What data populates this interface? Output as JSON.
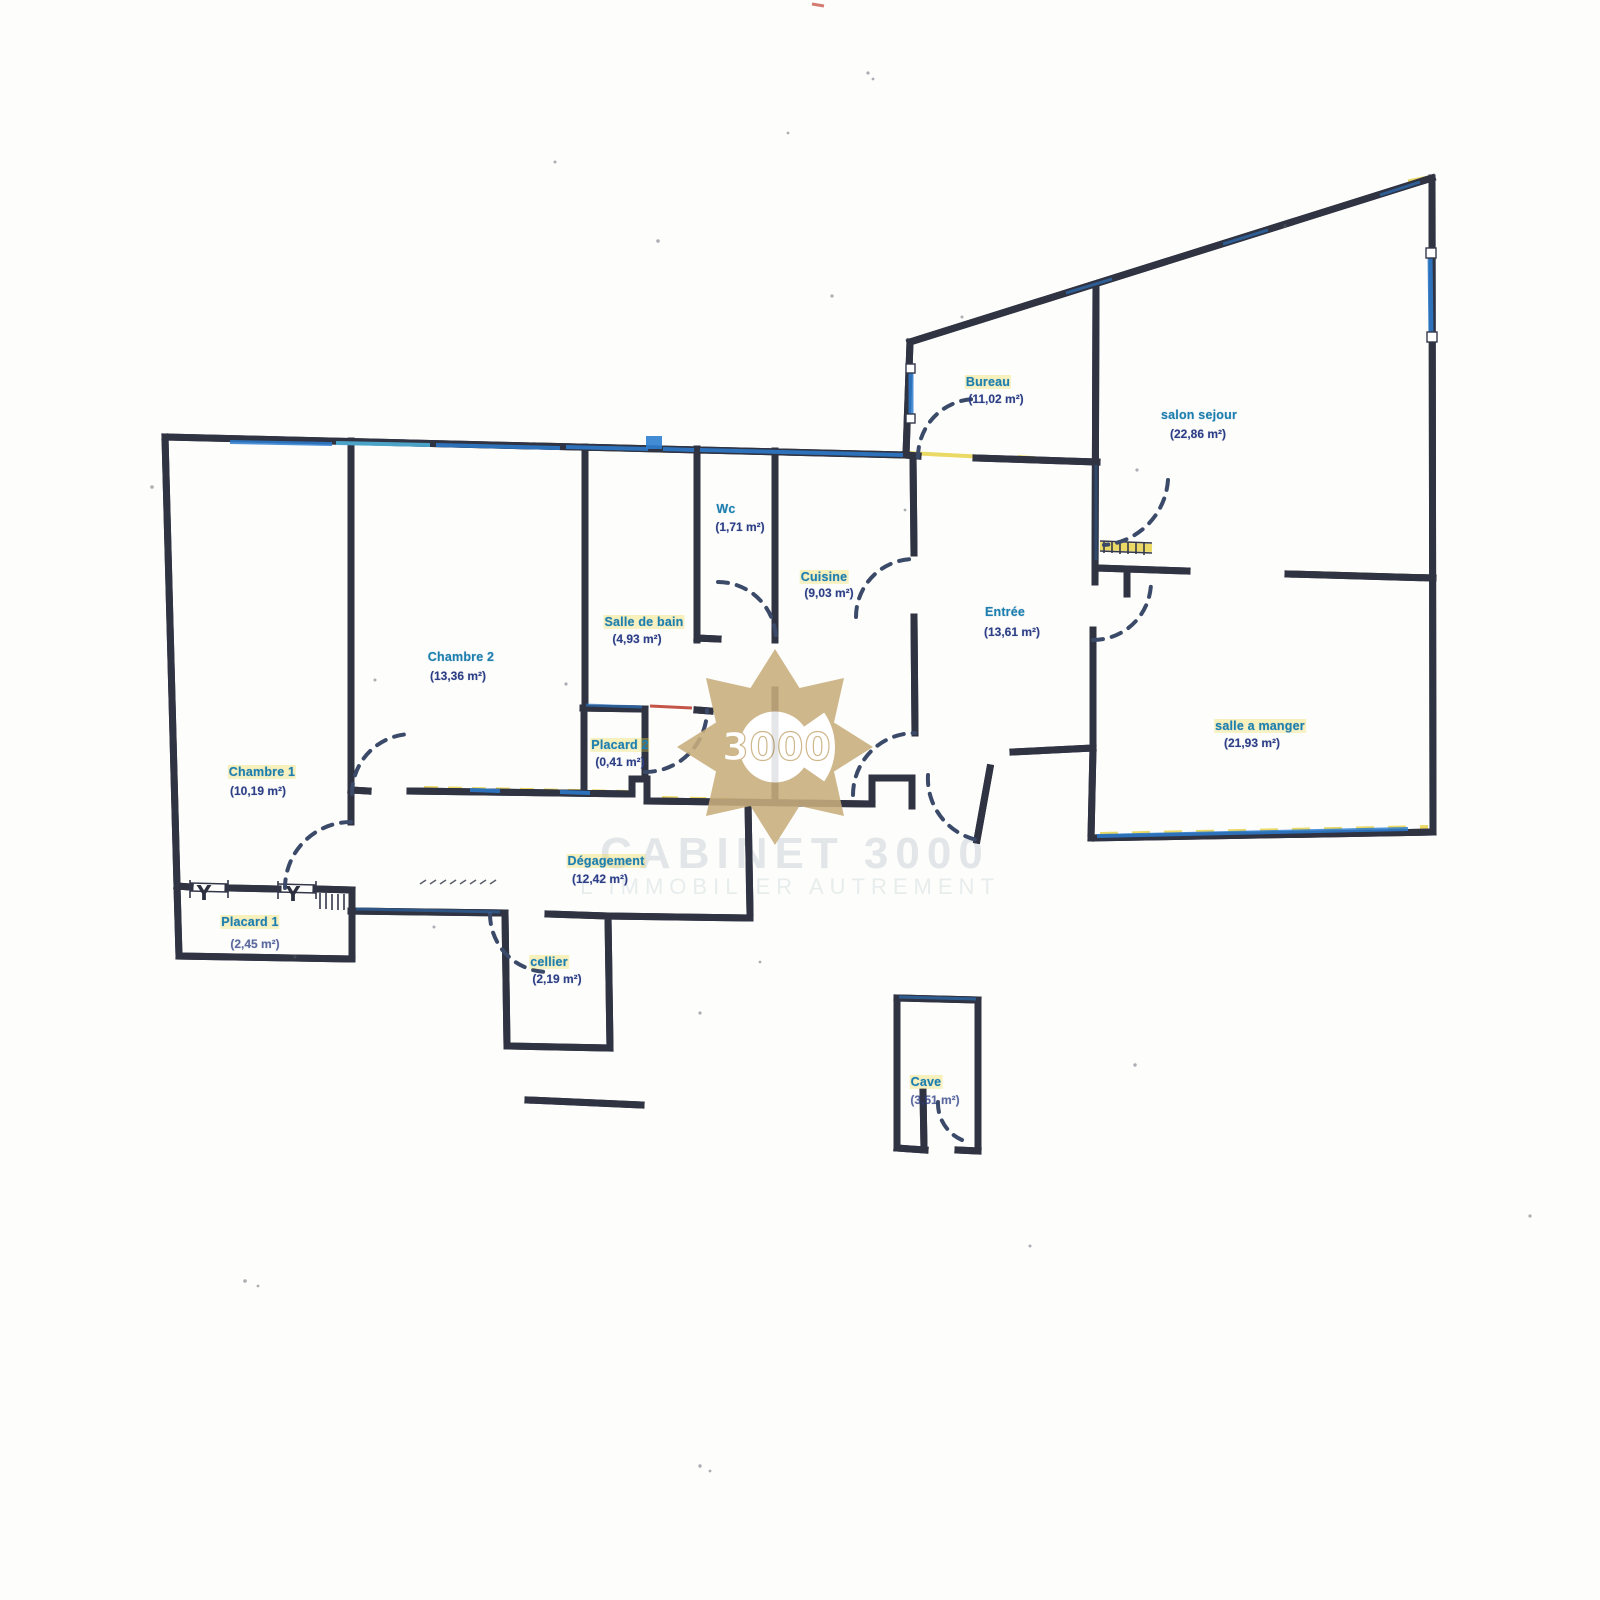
{
  "document": {
    "type": "floor-plan-scan",
    "language": "fr"
  },
  "rooms": {
    "chambre1": {
      "name": "Chambre 1",
      "area": "(10,19 m²)"
    },
    "chambre2": {
      "name": "Chambre 2",
      "area": "(13,36 m²)"
    },
    "salle_de_bain": {
      "name": "Salle de bain",
      "area": "(4,93 m²)"
    },
    "wc": {
      "name": "Wc",
      "area": "(1,71 m²)"
    },
    "placard2": {
      "name": "Placard 2",
      "area": "(0,41 m²)"
    },
    "cuisine": {
      "name": "Cuisine",
      "area": "(9,03 m²)"
    },
    "bureau": {
      "name": "Bureau",
      "area": "(11,02 m²)"
    },
    "salon_sejour": {
      "name": "salon sejour",
      "area": "(22,86 m²)"
    },
    "entree": {
      "name": "Entrée",
      "area": "(13,61 m²)"
    },
    "salle_a_manger": {
      "name": "salle a manger",
      "area": "(21,93 m²)"
    },
    "degagement": {
      "name": "Dégagement",
      "area": "(12,42 m²)"
    },
    "placard1": {
      "name": "Placard 1",
      "area": "(2,45 m²)"
    },
    "cellier": {
      "name": "cellier",
      "area": "(2,19 m²)"
    },
    "cave": {
      "name": "Cave",
      "area": "(3,51 m²)"
    }
  },
  "watermark": {
    "letter": "C",
    "number": "3000",
    "line1": "CABINET 3000",
    "line2": "L'IMMOBILIER AUTREMENT",
    "gold": "#c9ae7d"
  },
  "windows": {
    "symbol": "Y"
  },
  "colors": {
    "wall": "#2f3342",
    "door_arc": "#3a4a68",
    "highlight_blue": "#2e7ed0",
    "highlight_cyan": "#53c0ea",
    "highlight_yellow": "#e8d34a",
    "artifact_red": "#c04335",
    "label_name": "#1d7fae",
    "label_area": "#2c3e85"
  }
}
